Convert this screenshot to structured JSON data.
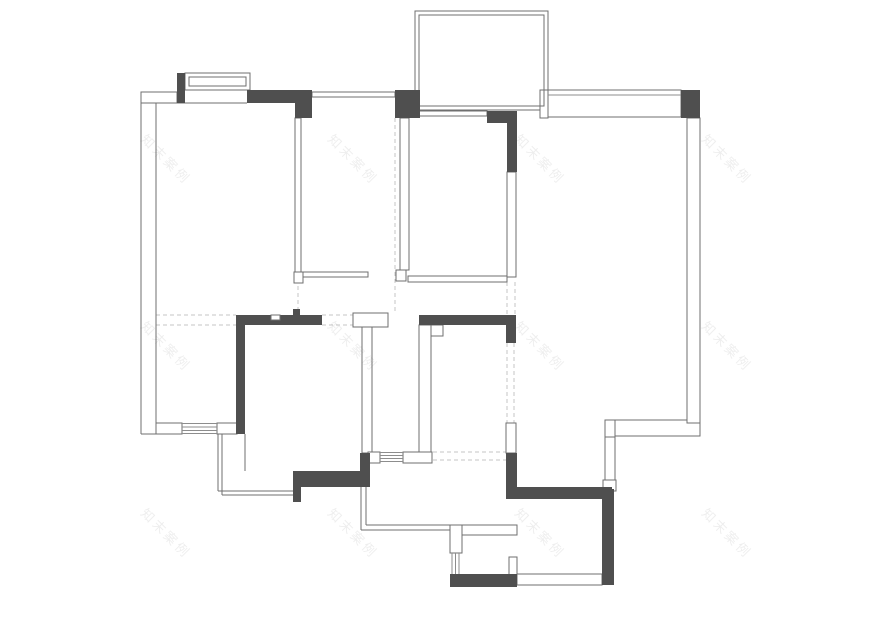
{
  "canvas": {
    "width": 880,
    "height": 622,
    "background": "#ffffff"
  },
  "colors": {
    "wall_dark": "#4f4f4f",
    "wall_line": "#6f6f6f",
    "window_line": "#8d8d8d",
    "dashed_line": "#c6c6c6",
    "white": "#ffffff",
    "watermark": "rgba(90,90,90,0.10)"
  },
  "watermark": {
    "text": "知末案例",
    "rotation": 45,
    "font_size": 13,
    "letter_spacing": 3,
    "positions": [
      [
        140,
        140
      ],
      [
        327,
        140
      ],
      [
        514,
        140
      ],
      [
        701,
        140
      ],
      [
        140,
        327
      ],
      [
        327,
        327
      ],
      [
        514,
        327
      ],
      [
        701,
        327
      ],
      [
        140,
        514
      ],
      [
        327,
        514
      ],
      [
        514,
        514
      ],
      [
        701,
        514
      ]
    ]
  },
  "plan": {
    "dark_walls": [
      [
        177,
        73,
        8,
        30
      ],
      [
        247,
        90,
        65,
        13
      ],
      [
        295,
        103,
        17,
        15
      ],
      [
        395,
        90,
        25,
        28
      ],
      [
        681,
        90,
        19,
        28
      ],
      [
        487,
        111,
        30,
        12
      ],
      [
        507,
        111,
        10,
        61
      ],
      [
        236,
        315,
        86,
        10
      ],
      [
        293,
        309,
        7,
        7
      ],
      [
        419,
        315,
        97,
        10
      ],
      [
        506,
        325,
        10,
        18
      ],
      [
        236,
        325,
        9,
        109
      ],
      [
        360,
        453,
        10,
        34
      ],
      [
        506,
        453,
        11,
        36
      ],
      [
        506,
        487,
        106,
        12
      ],
      [
        602,
        489,
        12,
        96
      ],
      [
        293,
        471,
        67,
        16
      ],
      [
        293,
        487,
        8,
        15
      ],
      [
        450,
        574,
        67,
        13
      ]
    ],
    "thin_walls": [
      [
        185,
        73,
        65,
        17
      ],
      [
        415,
        11,
        133,
        99
      ],
      [
        548,
        90,
        133,
        27
      ],
      [
        540,
        90,
        8,
        28
      ],
      [
        605,
        420,
        10,
        17
      ],
      [
        615,
        420,
        85,
        16
      ],
      [
        605,
        437,
        10,
        43
      ],
      [
        603,
        480,
        13,
        11
      ],
      [
        687,
        118,
        13,
        305
      ],
      [
        295,
        118,
        6,
        154
      ],
      [
        294,
        272,
        9,
        11
      ],
      [
        303,
        272,
        65,
        5
      ],
      [
        400,
        118,
        9,
        152
      ],
      [
        396,
        270,
        10,
        11
      ],
      [
        408,
        276,
        99,
        6
      ],
      [
        507,
        172,
        9,
        105
      ],
      [
        353,
        313,
        35,
        14
      ],
      [
        362,
        327,
        10,
        126
      ],
      [
        419,
        325,
        12,
        128
      ],
      [
        431,
        325,
        12,
        11
      ],
      [
        368,
        452,
        12,
        11
      ],
      [
        403,
        452,
        29,
        11
      ],
      [
        156,
        423,
        26,
        11
      ],
      [
        217,
        423,
        20,
        11
      ],
      [
        450,
        525,
        12,
        28
      ],
      [
        462,
        525,
        55,
        10
      ],
      [
        509,
        557,
        8,
        18
      ],
      [
        517,
        574,
        85,
        11
      ],
      [
        506,
        423,
        10,
        30
      ],
      [
        141,
        92,
        36,
        11
      ],
      [
        418,
        111,
        69,
        5
      ]
    ],
    "outlines": [
      [
        189,
        77,
        57,
        9
      ],
      [
        419,
        15,
        125,
        91
      ],
      [
        312,
        92,
        83,
        5
      ]
    ],
    "patches": [
      [
        271,
        315,
        9,
        5
      ]
    ],
    "lines": [
      [
        141,
        92,
        141,
        434
      ],
      [
        156,
        103,
        156,
        423
      ],
      [
        156,
        103,
        247,
        103
      ],
      [
        141,
        434,
        156,
        434
      ],
      [
        218,
        434,
        218,
        491
      ],
      [
        222,
        434,
        222,
        495
      ],
      [
        218,
        491,
        293,
        491
      ],
      [
        222,
        495,
        293,
        495
      ],
      [
        245,
        434,
        245,
        471
      ],
      [
        361,
        487,
        361,
        530
      ],
      [
        366,
        487,
        366,
        525
      ],
      [
        361,
        530,
        450,
        530
      ],
      [
        366,
        525,
        450,
        525
      ]
    ],
    "dashed": [
      [
        156,
        315,
        236,
        315
      ],
      [
        156,
        325,
        236,
        325
      ],
      [
        322,
        315,
        353,
        315
      ],
      [
        322,
        325,
        353,
        325
      ],
      [
        433,
        452,
        506,
        452
      ],
      [
        433,
        460,
        506,
        460
      ],
      [
        298,
        118,
        298,
        313
      ],
      [
        395,
        118,
        395,
        313
      ],
      [
        507,
        282,
        507,
        315
      ],
      [
        515,
        282,
        515,
        315
      ],
      [
        507,
        343,
        507,
        423
      ],
      [
        514,
        343,
        514,
        423
      ]
    ],
    "windows": [
      [
        182,
        423.5,
        217,
        423.5
      ],
      [
        182,
        427,
        217,
        427
      ],
      [
        182,
        430.5,
        217,
        430.5
      ],
      [
        182,
        433.5,
        217,
        433.5
      ],
      [
        380,
        452.5,
        403,
        452.5
      ],
      [
        380,
        455.5,
        403,
        455.5
      ],
      [
        380,
        458.5,
        403,
        458.5
      ],
      [
        380,
        461.5,
        403,
        461.5
      ],
      [
        452,
        553,
        452,
        574
      ],
      [
        455.5,
        553,
        455.5,
        574
      ],
      [
        459,
        553,
        459,
        574
      ],
      [
        548,
        95,
        681,
        95
      ]
    ]
  }
}
